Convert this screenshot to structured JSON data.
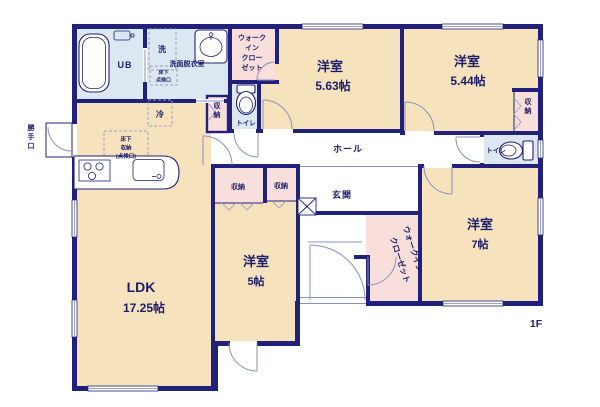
{
  "floor_label": "1F",
  "colors": {
    "wall": "#21217b",
    "room_beige": "#f6e3bd",
    "closet_pink": "#f8dfdb",
    "wet_area_blue": "#dde7f1",
    "text_navy": "#1d1d6b"
  },
  "rooms": {
    "ldk": {
      "name": "LDK",
      "size": "17.25帖"
    },
    "bedroom_north": {
      "name": "洋室",
      "size": "5.63帖"
    },
    "bedroom_northeast": {
      "name": "洋室",
      "size": "5.44帖"
    },
    "bedroom_southeast": {
      "name": "洋室",
      "size": "7帖"
    },
    "bedroom_south": {
      "name": "洋室",
      "size": "5帖"
    },
    "hall": {
      "name": "ホール"
    },
    "entrance": {
      "name": "玄関"
    },
    "washroom": {
      "name": "洗面脱衣室"
    },
    "unit_bath": {
      "name": "UB"
    },
    "toilet_north": {
      "name": "トイレ"
    },
    "toilet_east": {
      "name": "トイレ"
    },
    "wic_north": {
      "line1": "ウォーク",
      "line2": "イン",
      "line3": "クロー",
      "line4": "ゼット"
    },
    "wic_south": {
      "line1": "ウォークイン",
      "line2": "クローゼット"
    },
    "closet_a": {
      "name": "収納"
    },
    "closet_b": {
      "name": "収納"
    },
    "closet_hall": {
      "name": "収納"
    },
    "closet_east": {
      "name": "収納"
    }
  },
  "fixtures": {
    "washer": "洗",
    "fridge": "冷",
    "back_door": "勝手口",
    "underfloor_hatch": {
      "line1": "床下",
      "line2": "点検口"
    },
    "underfloor_storage": {
      "line1": "床下",
      "line2": "収納",
      "line3": "(点検口)"
    }
  }
}
